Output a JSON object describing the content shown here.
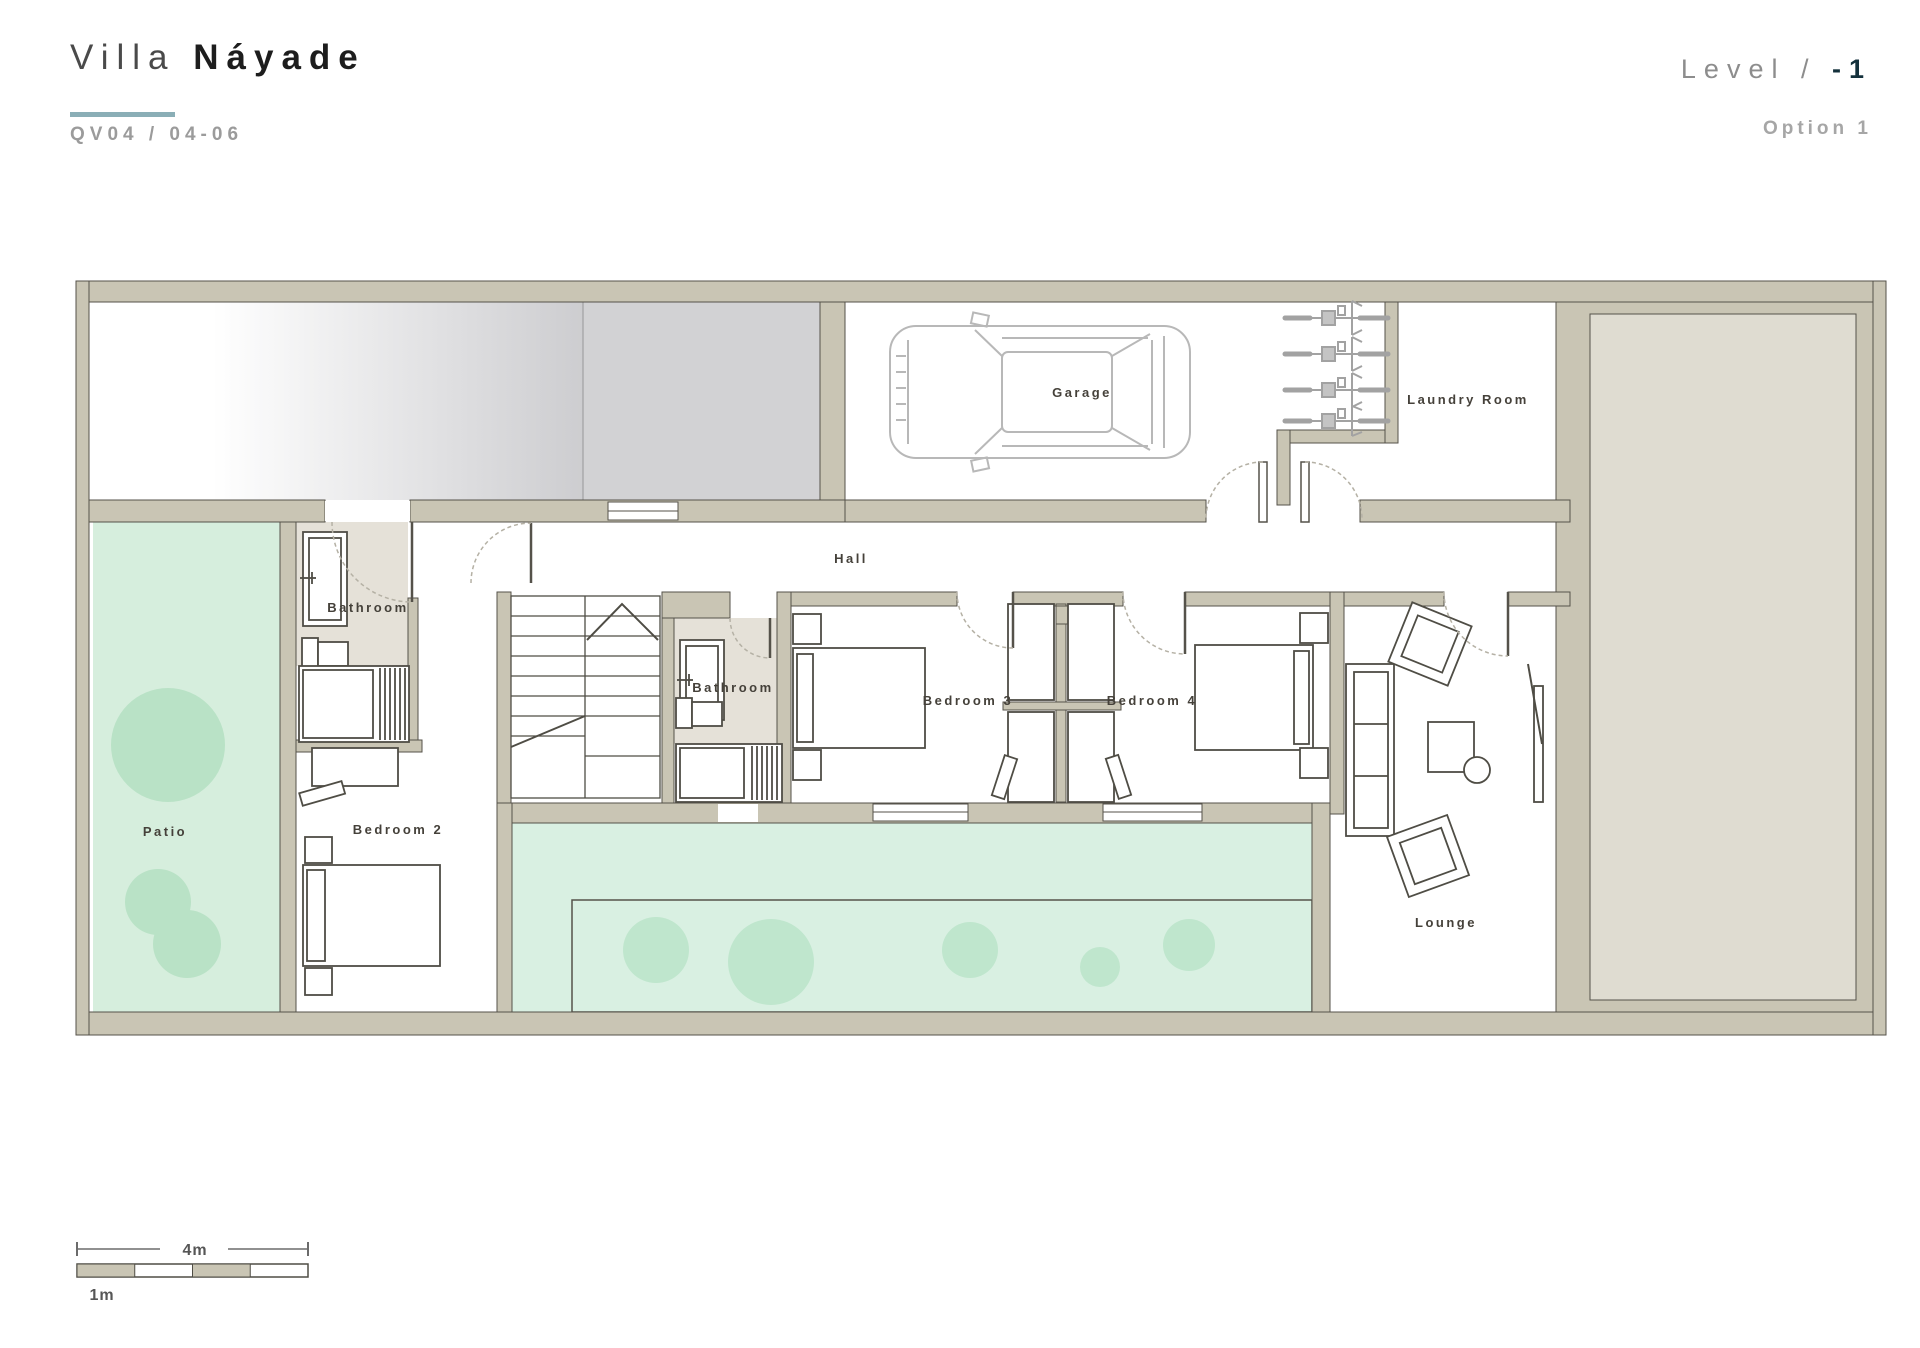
{
  "header": {
    "title": {
      "light": "Villa",
      "bold": "Náyade"
    },
    "reference": "QV04 / 04-06",
    "level": {
      "label": "Level /",
      "value": "-1"
    },
    "option": "Option 1"
  },
  "plan": {
    "labels": {
      "garage": "Garage",
      "laundry_room": "Laundry Room",
      "hall": "Hall",
      "bathroom_1": "Bathroom",
      "bathroom_2": "Bathroom",
      "bedroom_2": "Bedroom 2",
      "bedroom_3": "Bedroom 3",
      "bedroom_4": "Bedroom 4",
      "patio": "Patio",
      "lounge": "Lounge"
    },
    "colors": {
      "wall": "#c9c5b4",
      "wall_outline": "#55524a",
      "terrain": "#dfdcd1",
      "bath_floor": "#e5e1d8",
      "patio_green": "#d6eedd",
      "pool_green": "#d9f0e2",
      "tree_green": "#b9e2c6",
      "pool_tree_green": "#bfe6cd",
      "ramp_gray": "#d2d2d4",
      "car_line": "#b8b8b8",
      "accent": "#8aaeb6",
      "label_text": "#45413a"
    }
  },
  "scale_bar": {
    "total": "4m",
    "unit": "1m"
  }
}
